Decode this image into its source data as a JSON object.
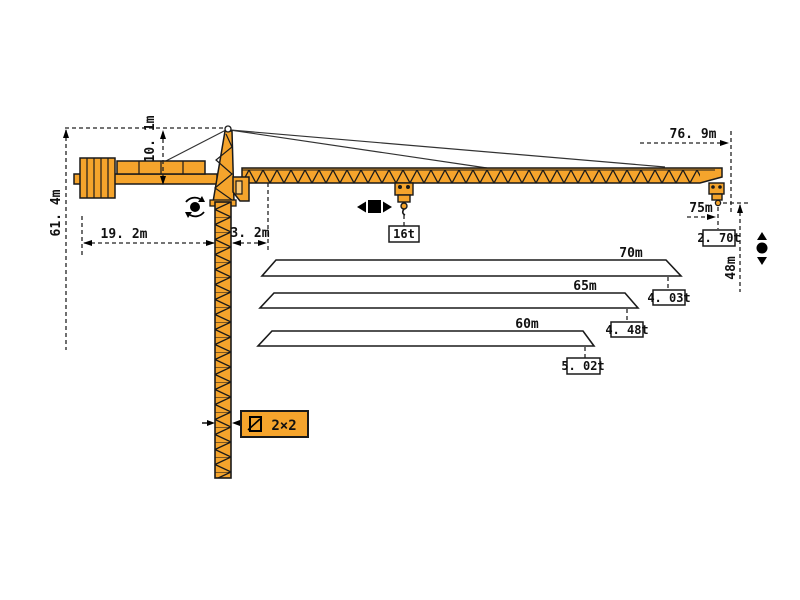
{
  "labels": {
    "total_height": "61. 4m",
    "head_height": "10. 1m",
    "counter_radius": "19. 2m",
    "rear_offset": "3. 2m",
    "max_length": "76. 9m",
    "max_hook_radius": "75m",
    "hook_height": "48m",
    "trolley_load": "16t",
    "tip_load": "2. 70t",
    "mast_section": "2×2"
  },
  "jib_options": [
    {
      "length": "70m",
      "tip_load": "4. 03t"
    },
    {
      "length": "65m",
      "tip_load": "4. 48t"
    },
    {
      "length": "60m",
      "tip_load": "5. 02t"
    }
  ],
  "icons": [
    "slewing-icon",
    "trolley-travel-icon",
    "hoist-icon",
    "mast-section-icon"
  ],
  "colors": {
    "crane_orange": "#F5A42C",
    "outline": "#1A1A1A",
    "dimension_line": "#222222"
  }
}
